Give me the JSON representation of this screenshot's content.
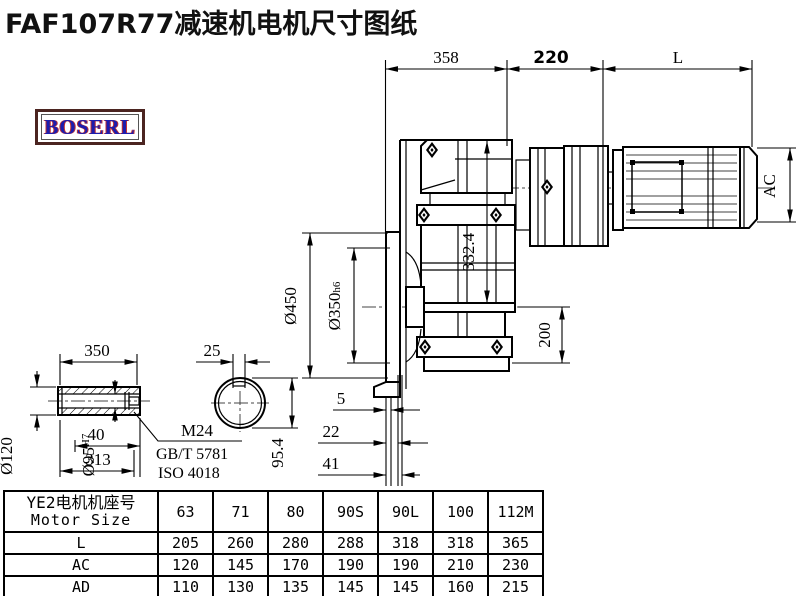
{
  "title": "FAF107R77减速机电机尺寸图纸",
  "logo": {
    "text": "BOSERL"
  },
  "drawing": {
    "dims": {
      "gear_len": "358",
      "adapter_len": "220",
      "motor_len": "L",
      "motor_height": "AC",
      "flange_od": "Ø450",
      "spigot_dia": "Ø350",
      "spigot_tol": "h6",
      "total_height": "332.4",
      "center_to_base": "200",
      "offset_a": "5",
      "offset_b": "22",
      "offset_c": "41"
    },
    "shaft": {
      "length": "350",
      "key_width": "25",
      "outer_dia": "Ø120",
      "bore_dia": "Ø95",
      "bore_tol": "H7",
      "dim_40": "40",
      "dim_313": "313",
      "bore_key_height": "95.4",
      "thread": "M24",
      "standard_gb": "GB/T 5781",
      "standard_iso": "ISO 4018"
    }
  },
  "table": {
    "header_cn": "YE2电机机座号",
    "header_en": "Motor Size",
    "sizes": [
      "63",
      "71",
      "80",
      "90S",
      "90L",
      "100",
      "112M"
    ],
    "rows": [
      {
        "label": "L",
        "values": [
          "205",
          "260",
          "280",
          "288",
          "318",
          "318",
          "365"
        ]
      },
      {
        "label": "AC",
        "values": [
          "120",
          "145",
          "170",
          "190",
          "190",
          "210",
          "230"
        ]
      },
      {
        "label": "AD",
        "values": [
          "110",
          "130",
          "135",
          "145",
          "145",
          "160",
          "215"
        ]
      }
    ]
  }
}
